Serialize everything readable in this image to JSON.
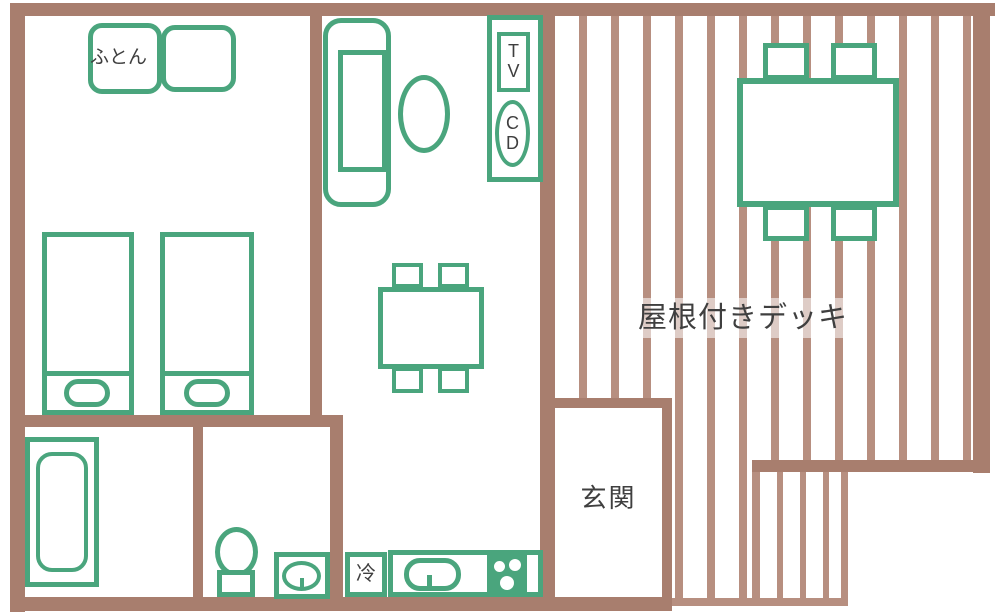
{
  "type": "floor-plan",
  "colors": {
    "wall": "#a87e6e",
    "plank": "#b78f80",
    "green": "#4aa57d",
    "label": "#3f3f3f"
  },
  "labels": {
    "futon": "ふとん",
    "entrance": "玄関",
    "deck": "屋根付きデッキ",
    "fridge": "冷",
    "tv": "TV",
    "cd": "CD"
  }
}
